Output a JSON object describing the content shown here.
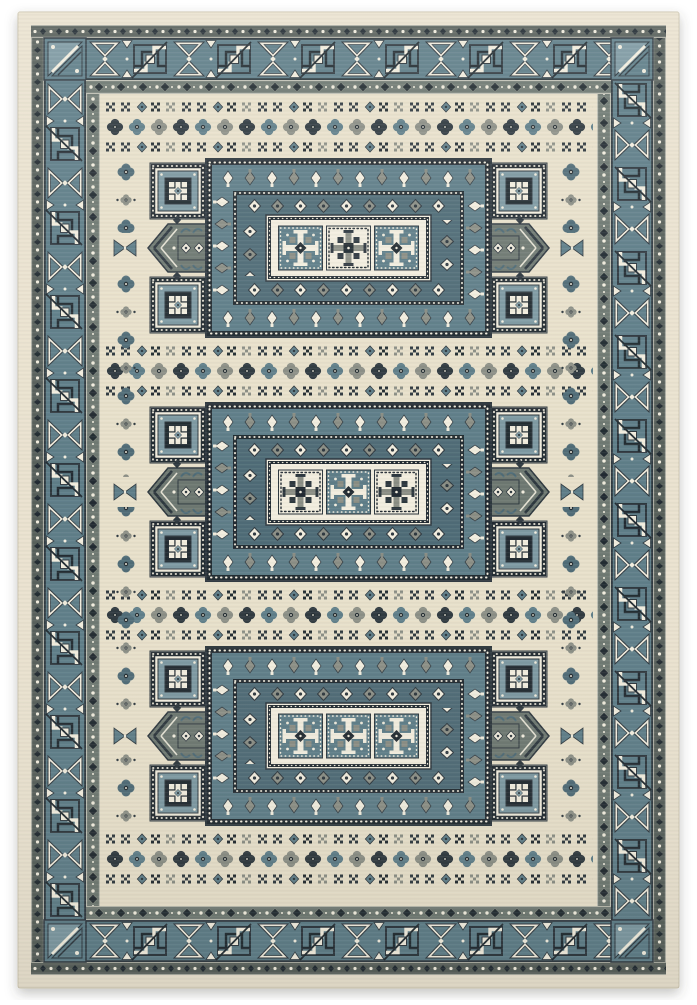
{
  "meta": {
    "title": "Ivory and teal traditional area rug",
    "description": "Top-down product photo of a rectangular ivory-cream area rug with slate-teal geometric ornament: a main border of ivory hourglass and teal key-spiral motifs between dark guard bands, and a field holding three rectangular medallion panels separated by rows of rosettes and small cross motifs."
  },
  "palette": {
    "bg": "#ffffff",
    "cream": "#eae2cf",
    "field": "#e8e0ca",
    "ivory": "#f2edde",
    "teal": "#5e7d88",
    "tealLight": "#7d99a2",
    "tealDeep": "#4f6b76",
    "gray": "#8b8e85",
    "olive": "#6e7871",
    "guard": "#575f5a",
    "dark": "#2d373e",
    "black": "#212a30"
  },
  "rug": {
    "type": "rectangular area rug",
    "style": "traditional geometric, Caucasian Kazak inspired",
    "border": {
      "bands_outer_to_inner": [
        "ivory selvage edge",
        "dark dot-and-diamond outer guard",
        "teal main border of ivory hourglasses and key spirals",
        "dark diamond-chain inner guard"
      ],
      "main_border_motifs": [
        "ivory-hourglass",
        "teal-key-spiral"
      ],
      "corner_motif": "diagonal split triangles with ivory chevron"
    },
    "field": {
      "background": "ivory-cream with fine horizontal pile striations",
      "motif_row_order": [
        "x-cross row",
        "rosette row",
        "x-cross row"
      ],
      "x_rows_count": 8,
      "rosette_rows_count": 4,
      "rosettes_per_row": 22,
      "rosette_colors": [
        "charcoal",
        "teal",
        "gray"
      ],
      "side_columns": "vertical rosette chains flanking the medallion panels",
      "panels": [
        {
          "name": "top medallion panel",
          "center_squares": [
            "teal-cross",
            "ivory-snowflake",
            "teal-cross"
          ]
        },
        {
          "name": "middle medallion panel",
          "center_squares": [
            "ivory-snowflake",
            "teal-cross",
            "ivory-snowflake"
          ]
        },
        {
          "name": "bottom medallion panel",
          "center_squares": [
            "dotted guard frame",
            "",
            ""
          ]
        }
      ],
      "panel_elements": [
        "white-dotted black guard frames",
        "diamond-pendant bands on teal",
        "inner diamond ring on deep teal",
        "three-square central medallion",
        "corner star squares on black",
        "outward arrow pendants with scroll band",
        "edge bowties at panel midline"
      ]
    }
  }
}
